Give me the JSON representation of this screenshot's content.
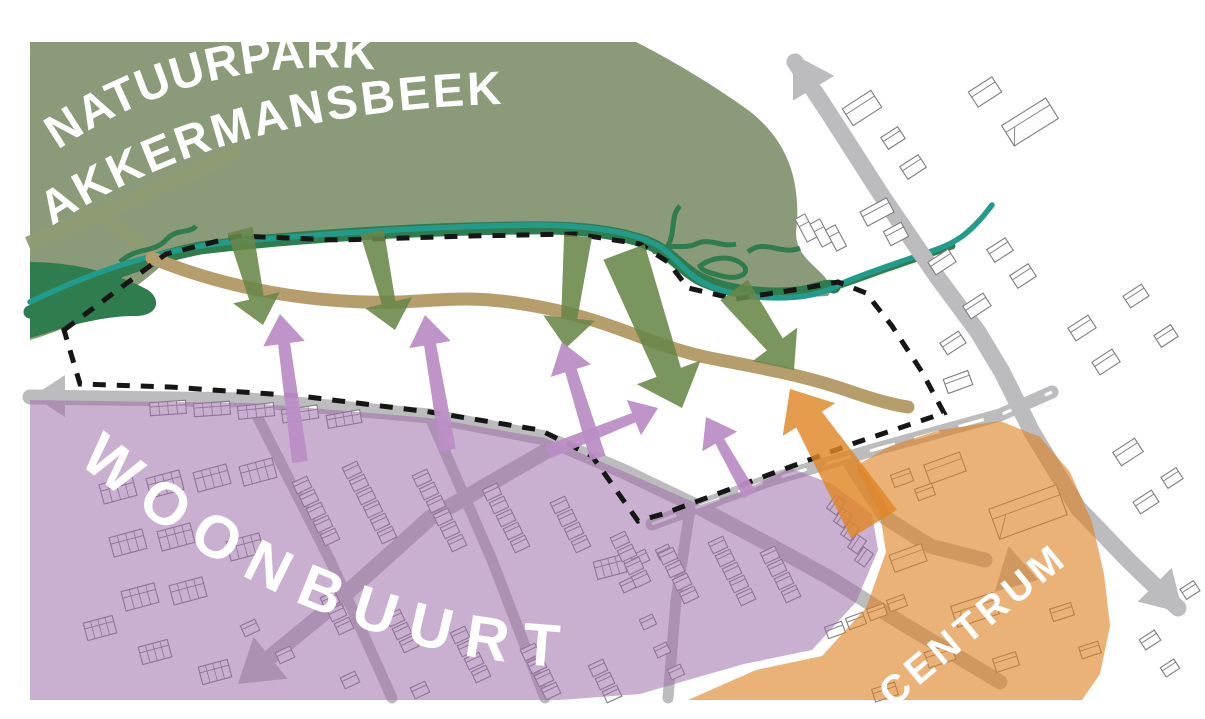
{
  "labels": {
    "nature_park_line1": "NATUURPARK",
    "nature_park_line2": "AKKERMANSBEEK",
    "residential_area": "WOONBUURT",
    "centre": "CENTRUM"
  },
  "colors": {
    "background": "#ffffff",
    "park": "#8B9A78",
    "creek": "#2F7C4E",
    "stream": "#219C8C",
    "park_trail": "#8F9B72",
    "route_trail": "#B59E6C",
    "residential_overlay": "rgba(158,112,170,0.55)",
    "centre_overlay": "rgba(221,130,35,0.62)",
    "green_arrow": "rgba(104,134,72,0.88)",
    "purple_arrow": "rgba(186,142,198,0.95)",
    "orange_arrow": "rgba(224,134,38,0.82)",
    "road": "#BCBBBE",
    "road_marking": "#ffffff",
    "boundary": "#161616",
    "building_fill": "#FDFDFD",
    "building_stroke": "#7d7d7d",
    "label_text": "#ffffff"
  },
  "map": {
    "roads": [
      {
        "name": "road-west-access",
        "d": "M30 397 L250 400 L430 416 L545 438 L625 472 L700 508 L770 545 L830 578 L900 622 L1000 682",
        "w": 15
      },
      {
        "name": "road-bypass",
        "d": "M652 524 L770 480 L880 448 L1000 415 L1052 392",
        "w": 13,
        "centerline": true
      },
      {
        "name": "road-main-north-south",
        "d": "M795 62 L830 115 L882 196 L938 278 L978 332 L1002 372 L1032 432 L1078 508 L1130 562 L1178 608",
        "w": 17
      },
      {
        "name": "road-southwest-branch",
        "d": "M548 450 L430 518 L330 608 L252 672",
        "w": 16
      },
      {
        "name": "street-woonbuurt-1",
        "d": "M252 406 L330 560 L392 698",
        "w": 11
      },
      {
        "name": "street-woonbuurt-2",
        "d": "M432 422 L492 560 L545 698",
        "w": 11
      },
      {
        "name": "street-woonbuurt-3",
        "d": "M690 510 L676 600 L668 698",
        "w": 11
      },
      {
        "name": "road-centrum-route",
        "d": "M852 466 L886 518 L930 546 L985 560",
        "w": 15
      }
    ],
    "road_arrowheads": [
      {
        "name": "road-arrow-west",
        "tip": [
          33,
          396
        ],
        "angle": 180,
        "w": 42,
        "l": 32
      },
      {
        "name": "road-arrow-north",
        "tip": [
          793,
          54
        ],
        "angle": -121,
        "w": 48,
        "l": 40
      },
      {
        "name": "road-arrow-southeast",
        "tip": [
          1183,
          613
        ],
        "angle": 45,
        "w": 48,
        "l": 40
      },
      {
        "name": "road-arrow-southwest",
        "tip": [
          238,
          684
        ],
        "angle": 141,
        "w": 54,
        "l": 42
      },
      {
        "name": "road-arrow-centrum",
        "tip": [
          1038,
          580
        ],
        "angle": 17,
        "w": 48,
        "l": 38
      }
    ],
    "flow_arrows": [
      {
        "name": "green-flow-1",
        "color": "green_arrow",
        "from": [
          240,
          230
        ],
        "to": [
          263,
          325
        ],
        "w1": 26,
        "w2": 15,
        "hw": 48,
        "hl": 28
      },
      {
        "name": "green-flow-2",
        "color": "green_arrow",
        "from": [
          372,
          232
        ],
        "to": [
          395,
          330
        ],
        "w1": 24,
        "w2": 14,
        "hw": 48,
        "hl": 28
      },
      {
        "name": "green-flow-3",
        "color": "green_arrow",
        "from": [
          578,
          236
        ],
        "to": [
          566,
          348
        ],
        "w1": 28,
        "w2": 16,
        "hw": 52,
        "hl": 30
      },
      {
        "name": "green-flow-4",
        "color": "green_arrow",
        "from": [
          624,
          252
        ],
        "to": [
          682,
          408
        ],
        "w1": 44,
        "w2": 26,
        "hw": 68,
        "hl": 38
      },
      {
        "name": "green-flow-5",
        "color": "green_arrow",
        "from": [
          734,
          290
        ],
        "to": [
          794,
          370
        ],
        "w1": 34,
        "w2": 20,
        "hw": 56,
        "hl": 32
      },
      {
        "name": "purple-flow-1",
        "color": "purple_arrow",
        "from": [
          300,
          462
        ],
        "to": [
          280,
          314
        ],
        "w1": 16,
        "w2": 12,
        "hw": 42,
        "hl": 30
      },
      {
        "name": "purple-flow-2",
        "color": "purple_arrow",
        "from": [
          448,
          450
        ],
        "to": [
          425,
          315
        ],
        "w1": 16,
        "w2": 12,
        "hw": 42,
        "hl": 30
      },
      {
        "name": "purple-flow-3",
        "color": "purple_arrow",
        "from": [
          598,
          458
        ],
        "to": [
          562,
          342
        ],
        "w1": 16,
        "w2": 12,
        "hw": 42,
        "hl": 30
      },
      {
        "name": "purple-flow-4",
        "color": "purple_arrow",
        "from": [
          548,
          452
        ],
        "to": [
          658,
          408
        ],
        "w1": 14,
        "w2": 10,
        "hw": 38,
        "hl": 26
      },
      {
        "name": "purple-flow-5",
        "color": "purple_arrow",
        "from": [
          750,
          495
        ],
        "to": [
          706,
          417
        ],
        "w1": 14,
        "w2": 10,
        "hw": 40,
        "hl": 28
      },
      {
        "name": "orange-flow-centrum",
        "color": "orange_arrow",
        "from": [
          874,
          524
        ],
        "to": [
          790,
          389
        ],
        "w1": 54,
        "w2": 30,
        "hw": 62,
        "hl": 36
      }
    ],
    "buildings": [
      [
        862,
        108,
        34,
        20,
        -33
      ],
      [
        893,
        138,
        20,
        14,
        -33
      ],
      [
        913,
        167,
        22,
        15,
        -33
      ],
      [
        985,
        92,
        28,
        18,
        -33
      ],
      [
        1030,
        122,
        52,
        24,
        -32,
        "big"
      ],
      [
        806,
        228,
        11,
        26,
        -28
      ],
      [
        821,
        233,
        11,
        26,
        -28
      ],
      [
        836,
        238,
        11,
        24,
        -28
      ],
      [
        877,
        212,
        30,
        16,
        -28
      ],
      [
        896,
        234,
        20,
        16,
        -28
      ],
      [
        942,
        262,
        24,
        15,
        -33
      ],
      [
        1000,
        250,
        22,
        15,
        -33
      ],
      [
        1023,
        276,
        22,
        15,
        -33
      ],
      [
        977,
        306,
        24,
        15,
        -33
      ],
      [
        953,
        343,
        22,
        14,
        -33
      ],
      [
        1082,
        328,
        24,
        15,
        -33
      ],
      [
        1106,
        362,
        24,
        15,
        -33
      ],
      [
        1136,
        296,
        22,
        14,
        -33
      ],
      [
        1166,
        336,
        20,
        14,
        -33
      ],
      [
        958,
        382,
        26,
        15,
        -20
      ],
      [
        1128,
        452,
        26,
        16,
        -33
      ],
      [
        1146,
        502,
        22,
        14,
        -33
      ],
      [
        1172,
        478,
        18,
        13,
        -33
      ],
      [
        1190,
        590,
        16,
        12,
        -33
      ],
      [
        1150,
        640,
        18,
        12,
        -33
      ],
      [
        1170,
        668,
        16,
        11,
        -33
      ],
      [
        118,
        490,
        34,
        20,
        -15,
        "grid"
      ],
      [
        165,
        484,
        34,
        20,
        -15,
        "grid"
      ],
      [
        212,
        478,
        34,
        20,
        -15,
        "grid"
      ],
      [
        258,
        472,
        34,
        20,
        -15,
        "grid"
      ],
      [
        128,
        543,
        34,
        20,
        -15,
        "grid"
      ],
      [
        176,
        537,
        34,
        20,
        -15,
        "grid"
      ],
      [
        245,
        547,
        34,
        20,
        -15,
        "grid"
      ],
      [
        140,
        597,
        34,
        20,
        -15,
        "grid"
      ],
      [
        188,
        591,
        34,
        20,
        -15,
        "grid"
      ],
      [
        100,
        628,
        30,
        18,
        -15,
        "grid"
      ],
      [
        155,
        652,
        30,
        18,
        -15,
        "grid"
      ],
      [
        215,
        672,
        30,
        18,
        -15,
        "grid"
      ],
      [
        168,
        408,
        36,
        13,
        -4,
        "grid"
      ],
      [
        212,
        409,
        36,
        13,
        -4,
        "grid"
      ],
      [
        256,
        411,
        36,
        13,
        -6,
        "grid"
      ],
      [
        300,
        414,
        36,
        13,
        -8,
        "grid"
      ],
      [
        344,
        419,
        34,
        13,
        -10,
        "grid"
      ],
      [
        610,
        567,
        30,
        18,
        -15,
        "grid"
      ],
      [
        250,
        628,
        16,
        12,
        -25
      ],
      [
        285,
        655,
        16,
        12,
        -25
      ],
      [
        350,
        680,
        16,
        12,
        -25
      ],
      [
        420,
        690,
        16,
        12,
        -25
      ],
      [
        640,
        558,
        16,
        12,
        -25
      ],
      [
        664,
        552,
        14,
        11,
        -25
      ],
      [
        628,
        585,
        14,
        11,
        -25
      ],
      [
        648,
        622,
        14,
        11,
        -25
      ],
      [
        662,
        650,
        14,
        11,
        -25
      ],
      [
        676,
        672,
        14,
        11,
        -25
      ],
      [
        835,
        630,
        18,
        12,
        -20
      ],
      [
        856,
        621,
        18,
        12,
        -20
      ],
      [
        877,
        612,
        18,
        12,
        -20
      ],
      [
        897,
        603,
        18,
        12,
        -20
      ],
      [
        1028,
        512,
        72,
        32,
        -20,
        "big"
      ],
      [
        945,
        468,
        38,
        20,
        -20
      ],
      [
        908,
        558,
        34,
        18,
        -20
      ],
      [
        975,
        610,
        44,
        22,
        -18,
        "big"
      ],
      [
        940,
        656,
        28,
        16,
        -18
      ],
      [
        1006,
        662,
        24,
        14,
        -18
      ],
      [
        1062,
        612,
        22,
        13,
        -18
      ],
      [
        885,
        692,
        24,
        13,
        -18
      ],
      [
        1090,
        650,
        20,
        12,
        -18
      ],
      [
        902,
        478,
        20,
        13,
        -20
      ],
      [
        925,
        492,
        18,
        12,
        -20
      ]
    ],
    "row_chains": [
      [
        302,
        485,
        5,
        -25
      ],
      [
        352,
        470,
        6,
        -25
      ],
      [
        422,
        478,
        6,
        -25
      ],
      [
        492,
        492,
        5,
        -25
      ],
      [
        560,
        505,
        4,
        -25
      ],
      [
        620,
        540,
        4,
        -25
      ],
      [
        668,
        556,
        4,
        -25
      ],
      [
        718,
        545,
        5,
        -25
      ],
      [
        770,
        555,
        4,
        -25
      ],
      [
        330,
        600,
        3,
        -25
      ],
      [
        395,
        618,
        3,
        -25
      ],
      [
        460,
        635,
        4,
        -25
      ],
      [
        530,
        652,
        4,
        -25
      ],
      [
        598,
        668,
        3,
        -25
      ],
      [
        836,
        505,
        5,
        -55
      ]
    ]
  }
}
